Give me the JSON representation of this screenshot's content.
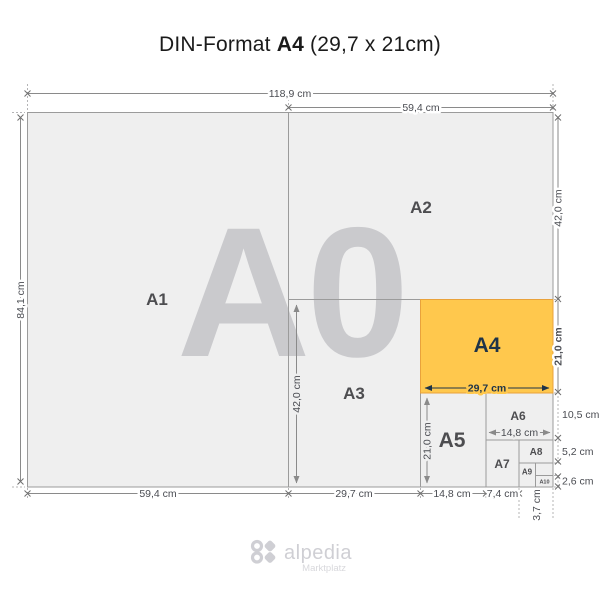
{
  "title": {
    "prefix": "DIN-Format ",
    "highlight": "A4",
    "suffix": " (29,7 x 21cm)"
  },
  "diagram": {
    "watermark": "A0",
    "labels": {
      "a1": "A1",
      "a2": "A2",
      "a3": "A3",
      "a4": "A4",
      "a5": "A5",
      "a6": "A6",
      "a7": "A7",
      "a8": "A8",
      "a9": "A9",
      "a10": "A10"
    },
    "dims": {
      "width_total": "118,9 cm",
      "width_a2": "59,4 cm",
      "height_total": "84,1 cm",
      "height_a2": "42,0 cm",
      "height_a4": "21,0 cm",
      "height_a6": "10,5 cm",
      "height_a8": "5,2 cm",
      "height_a10": "2,6 cm",
      "width_a1": "59,4 cm",
      "width_a3": "29,7 cm",
      "width_a5": "14,8 cm",
      "width_a7": "7,4 cm",
      "width_a9": "3,7 cm",
      "a3_inner_height": "42,0 cm",
      "a5_inner_height": "21,0 cm",
      "a4_inner_width": "29,7 cm",
      "a6_inner_width": "14,8 cm"
    },
    "colors": {
      "highlight_fill": "#ffc84d",
      "highlight_border": "#e9a23b",
      "highlight_text": "#1f3448",
      "paper_fill": "#efefef",
      "grid_line": "#9b9b9b"
    }
  },
  "footer": {
    "brand": "alpedia",
    "tagline": "Marktplatz"
  }
}
